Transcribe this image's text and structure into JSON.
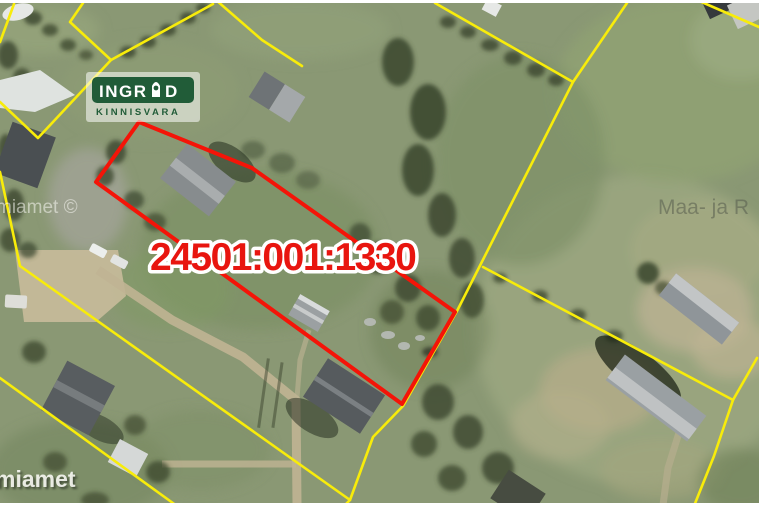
{
  "overlay": {
    "cadastral_number": "24501:001:1330",
    "logo": {
      "brand_left": "INGR",
      "brand_right": "D",
      "subtitle": "KINNISVARA"
    },
    "watermarks": {
      "mid_left": "miamet ©",
      "bottom_left": "miamet",
      "mid_right": "Maa- ja R"
    },
    "colors": {
      "boundary_yellow": "#f8ec0a",
      "parcel_red": "#f41408",
      "label_red": "#e8150f",
      "logo_green": "#215c38",
      "halo_white": "#ffffff"
    }
  }
}
